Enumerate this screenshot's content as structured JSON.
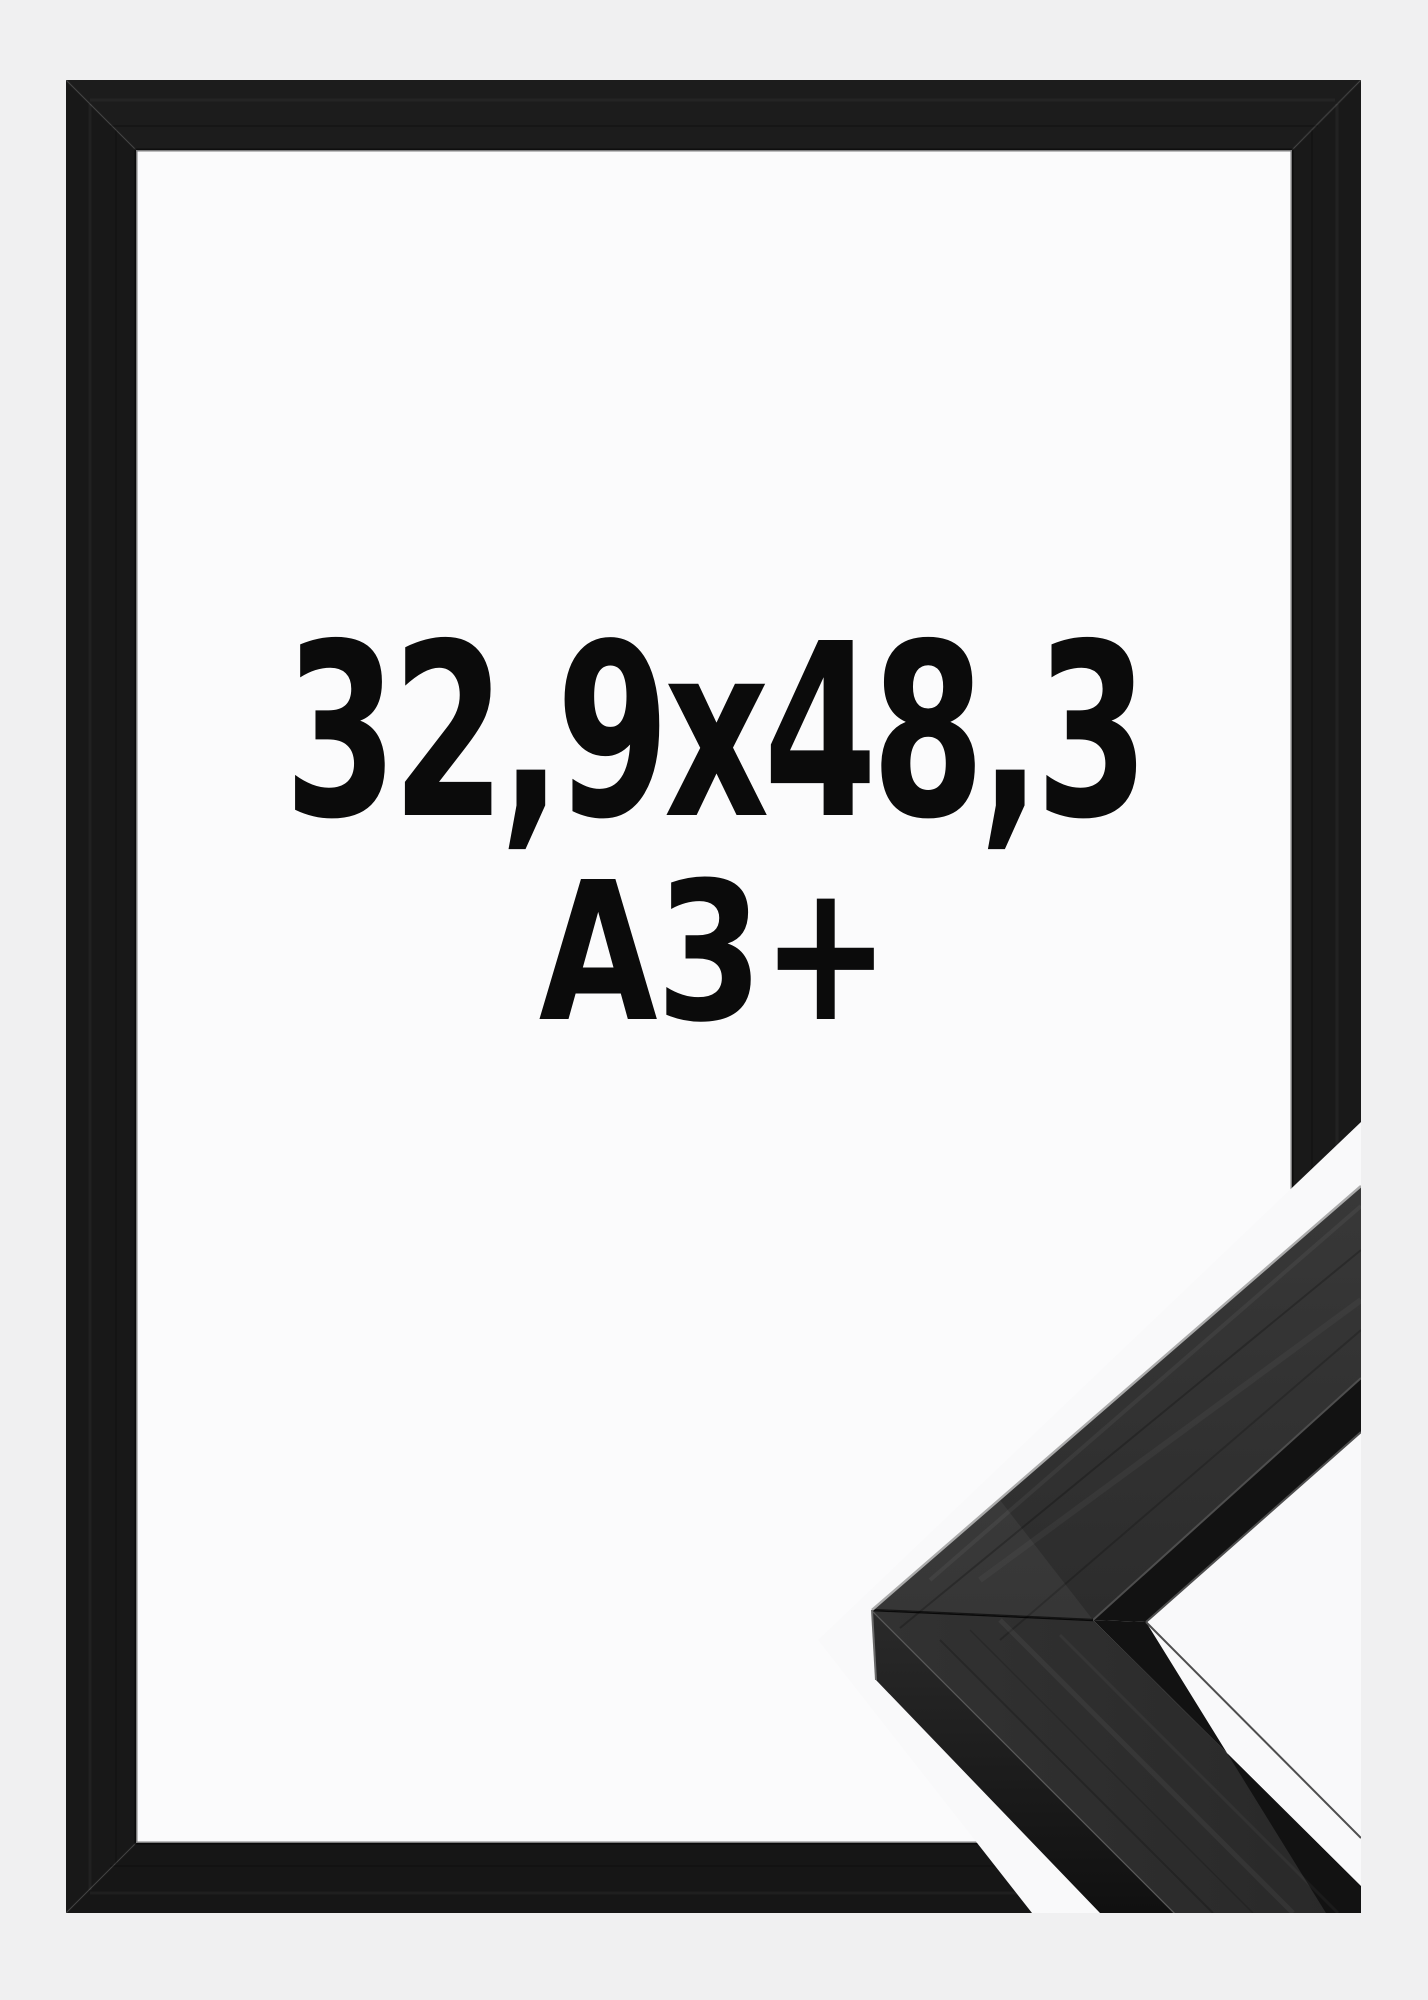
{
  "image": {
    "kind": "product-photo",
    "description": "Black picture frame shown front-on with size text, plus corner profile close-up inset at bottom right",
    "background_color": "#f0f0f1",
    "width_px": 1428,
    "height_px": 2000
  },
  "labels": {
    "size": "32,9x48,3",
    "format": "A3+",
    "text_color": "#0b0b0b"
  },
  "frame": {
    "band_top_color": "#1c1c1c",
    "band_right_color": "#191919",
    "band_bottom_color": "#161616",
    "band_left_color": "#181818",
    "interior_color": "#fbfbfc",
    "band_width_px": 70
  },
  "inset": {
    "background_color": "#f9f9fa",
    "moulding_top_arm_color": "#333333",
    "moulding_bottom_arm_color": "#2d2d2d",
    "moulding_side_color": "#1d1d1d",
    "rabbet_groove_color": "#121212",
    "edge_highlight_color": "#ababab"
  }
}
